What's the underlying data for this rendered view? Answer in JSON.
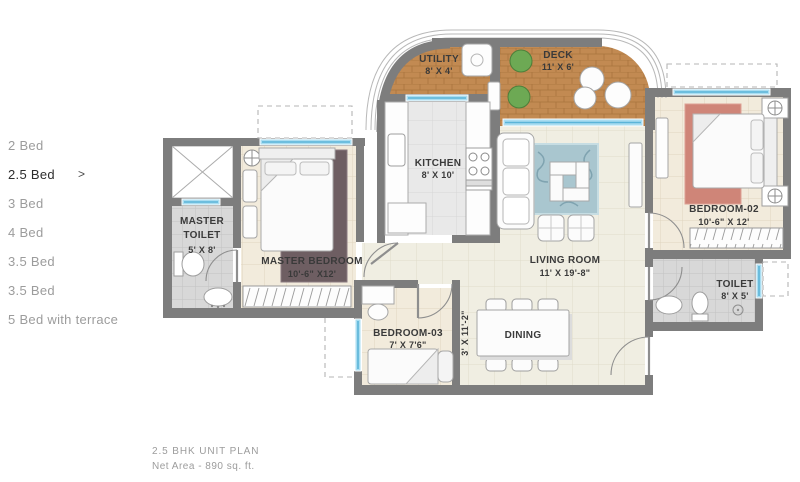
{
  "sidebar": {
    "items": [
      {
        "label": "2 Bed",
        "selected": false
      },
      {
        "label": "2.5 Bed",
        "selected": true
      },
      {
        "label": "3 Bed",
        "selected": false
      },
      {
        "label": "4 Bed",
        "selected": false
      },
      {
        "label": "3.5 Bed",
        "selected": false
      },
      {
        "label": "3.5 Bed",
        "selected": false
      },
      {
        "label": "5 Bed with terrace",
        "selected": false
      }
    ],
    "selected_arrow": ">"
  },
  "caption": {
    "title": "2.5  BHK UNIT PLAN",
    "subtitle": "Net Area - 890 sq. ft."
  },
  "plan": {
    "rooms": {
      "utility": {
        "name": "UTILITY",
        "dims": "8' X 4'"
      },
      "deck": {
        "name": "DECK",
        "dims": "11' X 6'"
      },
      "kitchen": {
        "name": "KITCHEN",
        "dims": "8' X 10'"
      },
      "living_room": {
        "name": "LIVING ROOM",
        "dims": "11' X 19'-8\""
      },
      "master_toilet": {
        "name_line1": "MASTER",
        "name_line2": "TOILET",
        "dims": "5' X 8'"
      },
      "master_bedroom": {
        "name": "MASTER BEDROOM",
        "dims": "10'-6\" X12'"
      },
      "bedroom_02": {
        "name": "BEDROOM-02",
        "dims": "10'-6\" X 12'"
      },
      "bedroom_03": {
        "name": "BEDROOM-03",
        "dims": "7' X 7'6\""
      },
      "toilet": {
        "name": "TOILET",
        "dims": "8' X 5'"
      },
      "dining": {
        "name": "DINING"
      },
      "passage": {
        "dims": "3' X 11'-2\""
      }
    },
    "colors": {
      "wall": "#7d7d7d",
      "wood_floor": "#c28a52",
      "window_blue": "#a9ddf1",
      "label_text": "#3a3a3a"
    }
  }
}
